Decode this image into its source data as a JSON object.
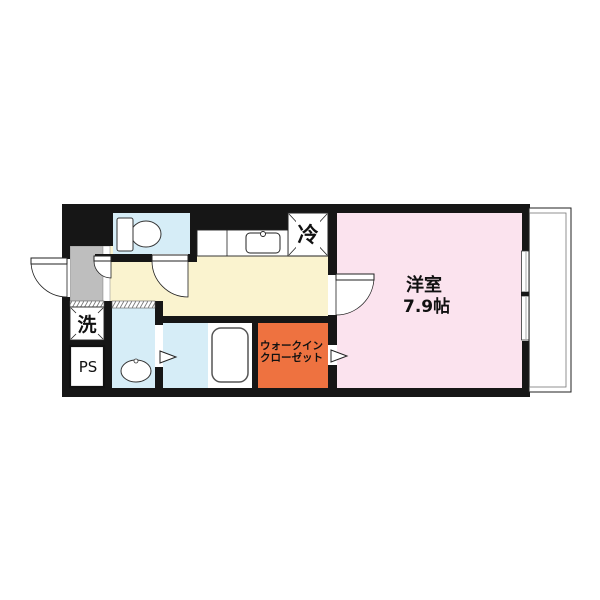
{
  "floor_plan": {
    "western_room": {
      "label": "洋室",
      "size": "7.9帖"
    },
    "walk_in_closet": {
      "line1": "ウォークイン",
      "line2": "クローゼット"
    },
    "refrigerator_label": "冷",
    "washer_label": "洗",
    "pipe_space_label": "PS"
  },
  "colors": {
    "wall": "#161616",
    "western_room": "#FBE3EE",
    "kitchen_hall": "#FAF3CF",
    "wet_rooms": "#D6EDF7",
    "walk_in_closet": "#EE7240",
    "entrance": "#BEBEBE"
  }
}
